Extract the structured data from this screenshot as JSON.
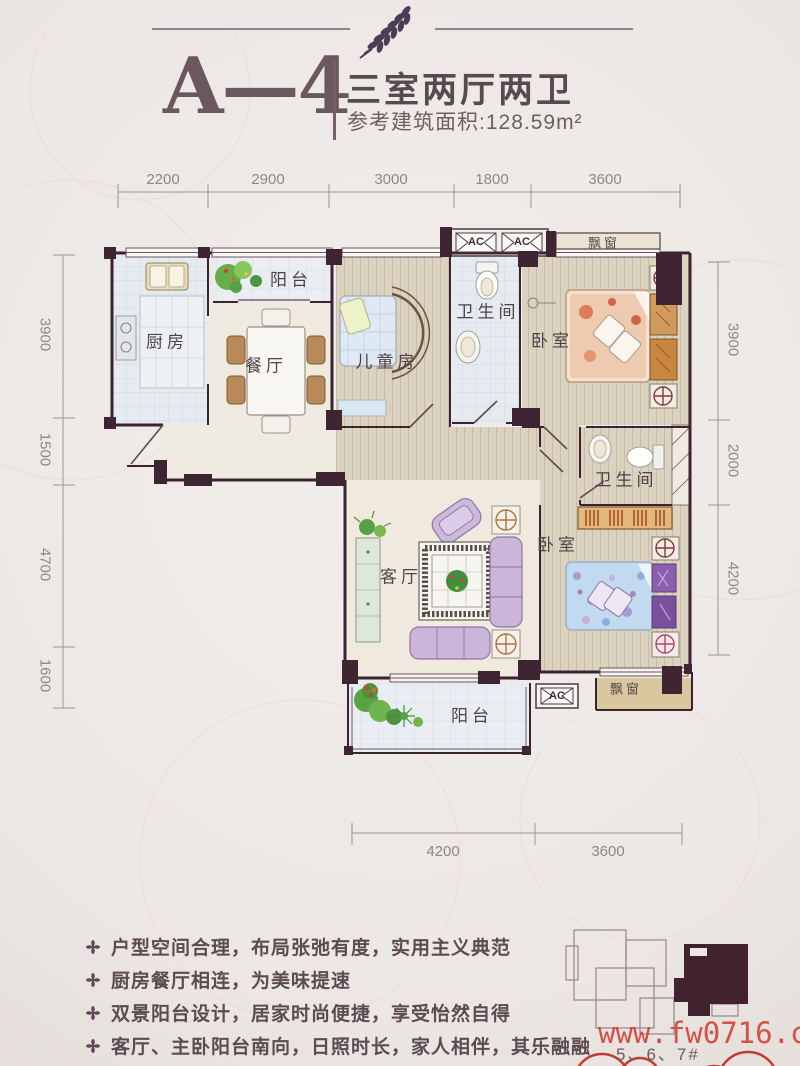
{
  "header": {
    "unit": "A—4",
    "layout_type": "三室两厅两卫",
    "area": "参考建筑面积:128.59m²"
  },
  "dims": {
    "top": [
      "2200",
      "2900",
      "3000",
      "1800",
      "3600"
    ],
    "left": [
      "3900",
      "1500",
      "4700",
      "1600"
    ],
    "right": [
      "3900",
      "2000",
      "4200"
    ],
    "bottom": [
      "4200",
      "3600"
    ]
  },
  "rooms": {
    "kitchen": "厨房",
    "balcony_top": "阳台",
    "dining": "餐厅",
    "kids_room": "儿童房",
    "bath1": "卫生间",
    "bedroom1": "卧室",
    "bath2": "卫生间",
    "bedroom2": "卧室",
    "living": "客厅",
    "balcony_bottom": "阳台"
  },
  "fixtures": {
    "ac1": "AC",
    "ac2": "AC",
    "ac3": "AC",
    "bay_top": "飘窗",
    "bay_bottom": "飘窗"
  },
  "features": {
    "items": [
      "户型空间合理，布局张弛有度，实用主义典范",
      "厨房餐厅相连，为美味提速",
      "双景阳台设计，居家时尚便捷，享受怡然自得",
      "客厅、主卧阳台南向，日照时长，家人相伴，其乐融融"
    ]
  },
  "site": {
    "label": "5、6、7#"
  },
  "watermark": "www.fw0716.com",
  "colors": {
    "wall": "#3f2433",
    "title": "#6b585e",
    "watermark_red": "#d03e2f",
    "wood_floor": "#dcd2c0",
    "sofa_purple": "#cbb6da"
  }
}
